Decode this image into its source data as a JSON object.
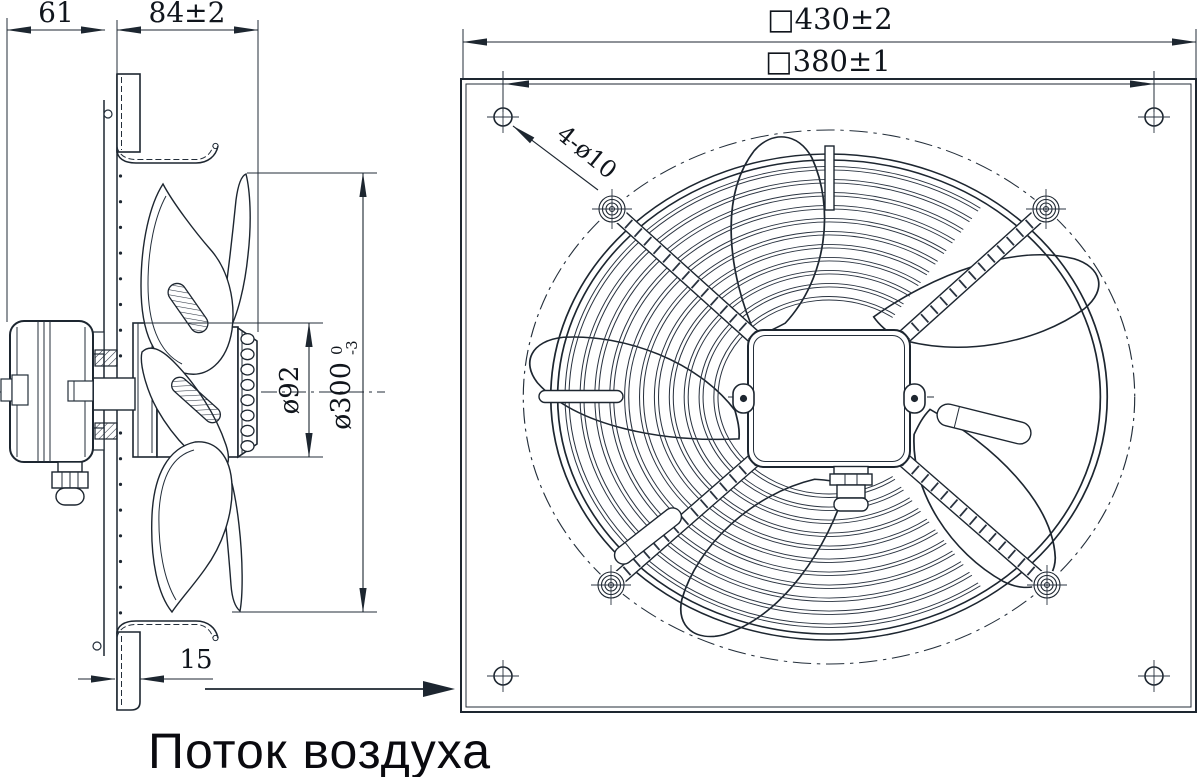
{
  "drawing": {
    "title": "axial-fan-technical-drawing",
    "line_color": "#1d2630",
    "background": "#ffffff"
  },
  "side_view": {
    "dims": {
      "motor_depth": "61",
      "total_depth": "84±2",
      "hub_diameter": "ø92",
      "impeller_diameter": "ø300",
      "impeller_tol_upper": "0",
      "impeller_tol_lower": "-3",
      "flange_depth": "15"
    }
  },
  "front_view": {
    "dims": {
      "outer_square": "□430±2",
      "bolt_square": "□380±1",
      "mount_holes": "4-ø10"
    }
  },
  "caption": {
    "airflow_label": "Поток воздуха"
  }
}
